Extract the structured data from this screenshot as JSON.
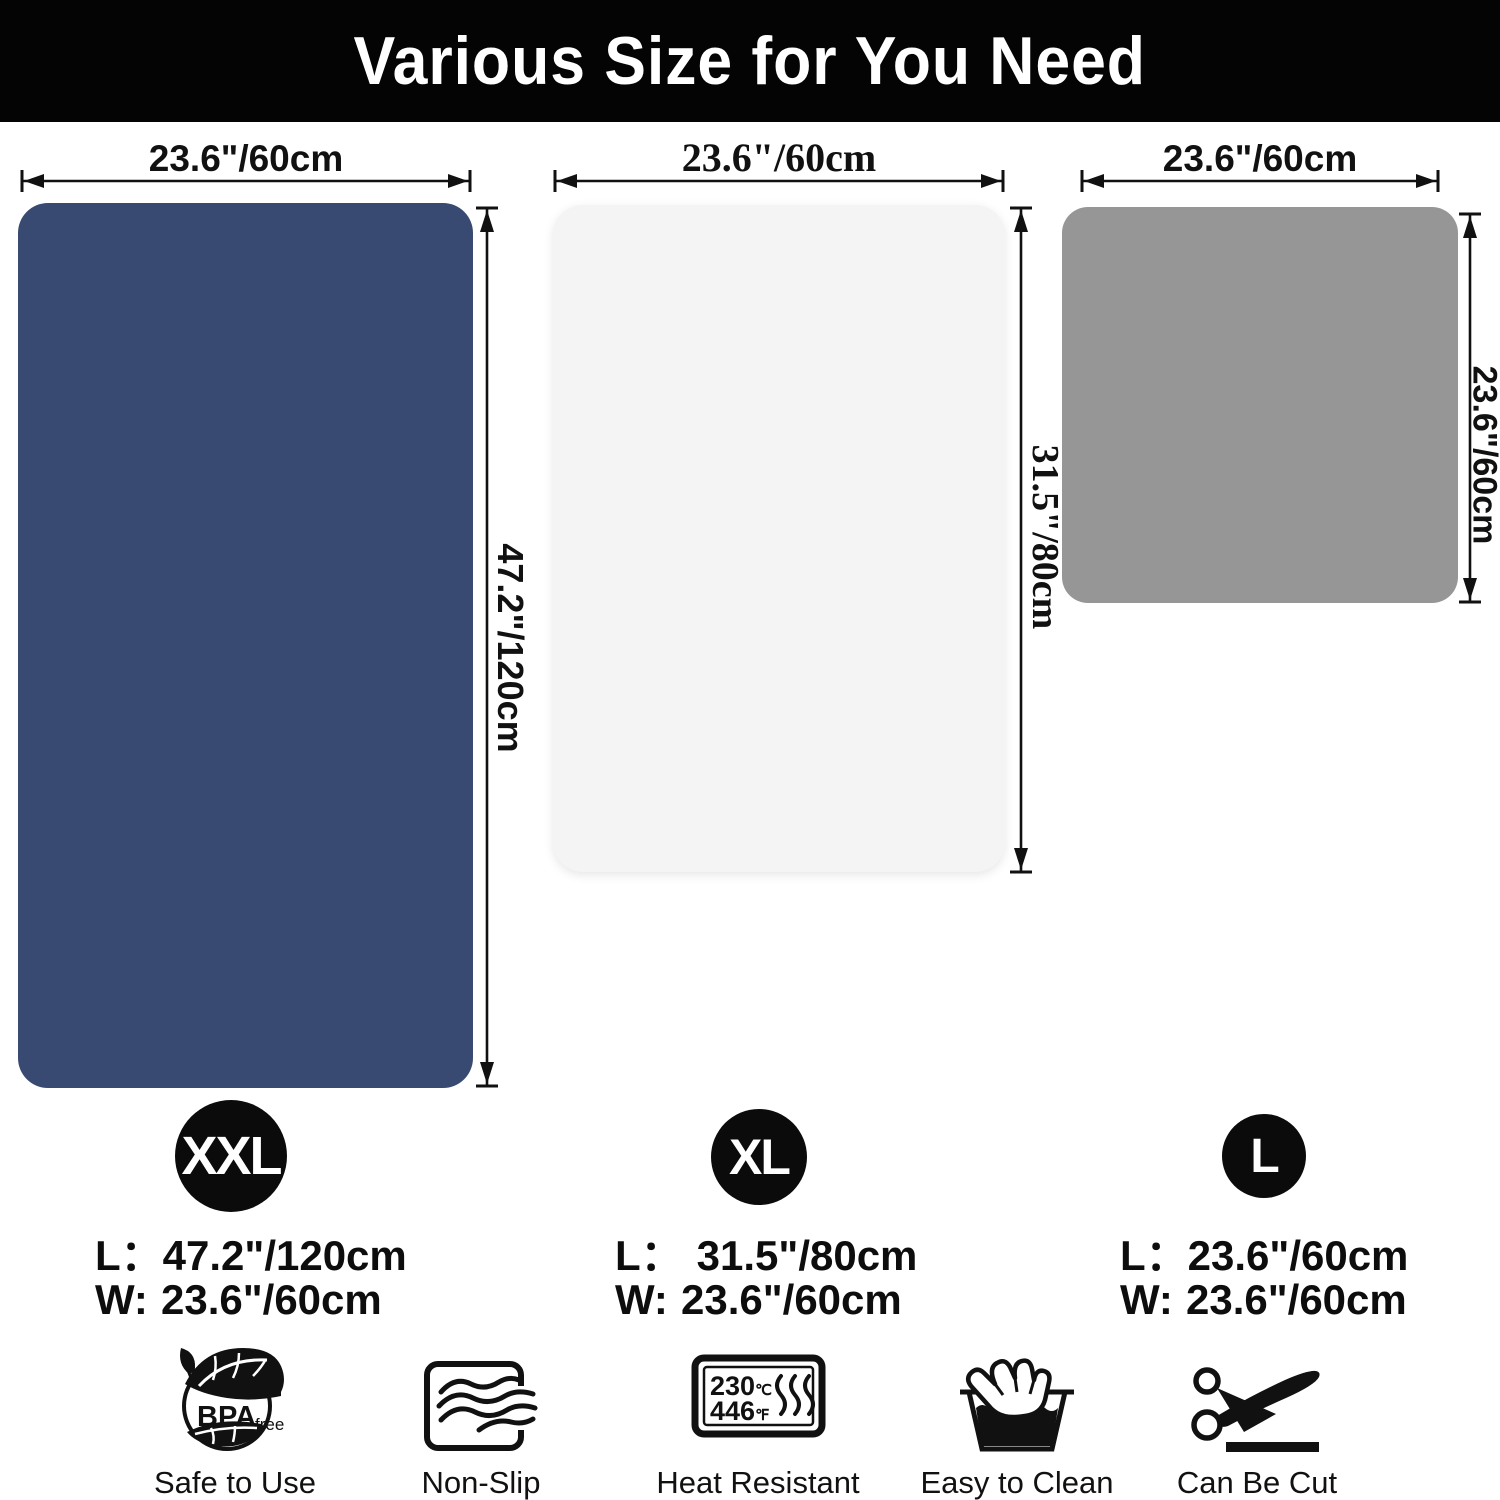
{
  "header": {
    "title": "Various Size for You Need"
  },
  "panels": [
    {
      "badge": "XXL",
      "top_dim": "23.6\"/60cm",
      "side_dim": "47.2\"/120cm",
      "length_label": "L：",
      "length_value": "47.2\"/120cm",
      "width_label": "W:",
      "width_value": "23.6\"/60cm",
      "mat_color": "#394a72"
    },
    {
      "badge": "XL",
      "top_dim": "23.6\"/60cm",
      "side_dim": "31.5\"/80cm",
      "length_label": "L：",
      "length_value": "31.5\"/80cm",
      "width_label": "W:",
      "width_value": "23.6\"/60cm",
      "mat_color": "#f4f4f4"
    },
    {
      "badge": "L",
      "top_dim": "23.6\"/60cm",
      "side_dim": "23.6\"/60cm",
      "length_label": "L：",
      "length_value": "23.6\"/60cm",
      "width_label": "W:",
      "width_value": "23.6\"/60cm",
      "mat_color": "#969696"
    }
  ],
  "features": [
    {
      "label": "Safe to Use",
      "badge_main": "BPA",
      "badge_sub": "free"
    },
    {
      "label": "Non-Slip"
    },
    {
      "label": "Heat Resistant",
      "temp_c": "230",
      "temp_c_unit": "℃",
      "temp_f": "446",
      "temp_f_unit": "℉"
    },
    {
      "label": "Easy to Clean"
    },
    {
      "label": "Can Be Cut"
    }
  ]
}
